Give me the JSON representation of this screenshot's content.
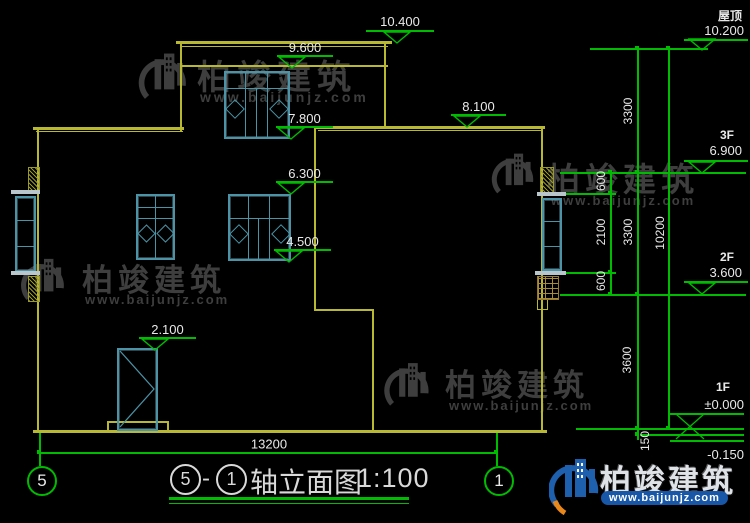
{
  "drawing": {
    "elevations": {
      "e10400": "10.400",
      "e9600": "9.600",
      "e8100": "8.100",
      "e7800": "7.800",
      "e6300": "6.300",
      "e4500": "4.500",
      "e2100": "2.100"
    },
    "floors": {
      "roof_name": "屋顶",
      "roof_value": "10.200",
      "f3_name": "3F",
      "f3_value": "6.900",
      "f2_name": "2F",
      "f2_value": "3.600",
      "f1_name": "1F",
      "f1_value": "±0.000",
      "basement_value": "-0.150"
    },
    "dims": {
      "total_width": "13200",
      "total_height": "10200",
      "d600_top": "600",
      "d2100": "2100",
      "d600_bottom": "600",
      "d3300_upper": "3300",
      "d3300_lower": "3300",
      "d3600": "3600",
      "d150": "150"
    },
    "axes": {
      "left": "5",
      "right": "1"
    },
    "title": {
      "axis_from": "5",
      "dash": "-",
      "axis_to": "1",
      "name": "轴立面图",
      "scale": "1:100"
    }
  },
  "watermark": {
    "brand": "柏竣建筑",
    "site": "www.baijunjz.com"
  },
  "footer": {
    "brand": "柏竣建筑",
    "site": "www.baijunjz.com"
  },
  "colors": {
    "background": "#000000",
    "wall_yellow": "#b9b931",
    "dimension_green": "#00bc00",
    "window_teal": "#4b93a7",
    "text_white": "#e9e9e9",
    "watermark_gray": "#3e3e3e",
    "brand_blue": "#1e5fae",
    "brand_orange": "#e8881a"
  }
}
